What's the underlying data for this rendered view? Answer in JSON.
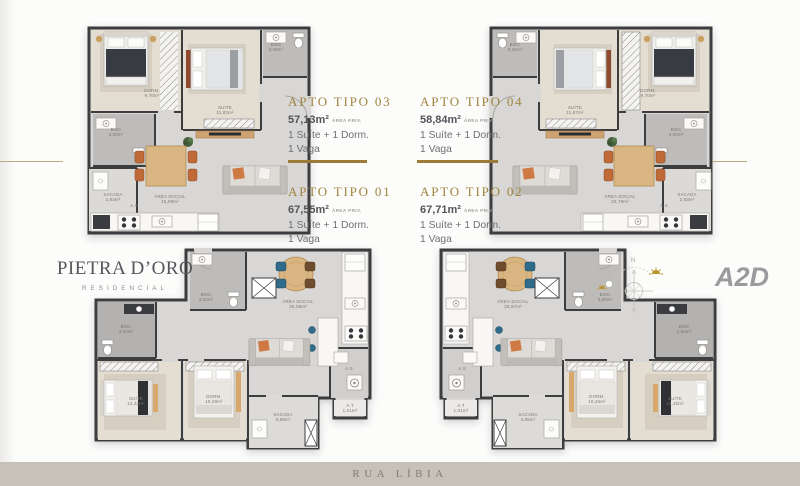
{
  "brand": {
    "name": "PIETRA D’ORO",
    "subtitle": "RESIDENCIAL"
  },
  "partner_logo": {
    "text": "A2D"
  },
  "compass": {
    "north_label": "N"
  },
  "footer": {
    "street_label": "RUA LÍBIA"
  },
  "colors": {
    "gold": "#a0843f",
    "rule_thin": "#bfa87e",
    "bar_gold": "#9c7b3a",
    "footer_bg": "#c6c2ba"
  },
  "units": {
    "items": [
      {
        "id": "tipo03",
        "title": "APTO TIPO 03",
        "area": "57,13m²",
        "area_note": "ÁREA PRIV.",
        "line1": "1 Suíte + 1 Dorm.",
        "line2": "1 Vaga"
      },
      {
        "id": "tipo04",
        "title": "APTO TIPO 04",
        "area": "58,84m²",
        "area_note": "ÁREA PRIV.",
        "line1": "1 Suíte + 1 Dorm.",
        "line2": "1 Vaga"
      },
      {
        "id": "tipo01",
        "title": "APTO TIPO 01",
        "area": "67,55m²",
        "area_note": "ÁREA PRIV.",
        "line1": "1 Suíte + 1 Dorm.",
        "line2": "1 Vaga"
      },
      {
        "id": "tipo02",
        "title": "APTO TIPO 02",
        "area": "67,71m²",
        "area_note": "ÁREA PRIV.",
        "line1": "1 Suíte + 1 Dorm.",
        "line2": "1 Vaga"
      }
    ]
  },
  "plans": {
    "tipo03": {
      "rooms": {
        "dorm": {
          "name": "DORM.",
          "area": "9,70m²"
        },
        "suite": {
          "name": "SUÍTE",
          "area": "11,82m²"
        },
        "bwc_top": {
          "name": "BWC",
          "area": "3,09m²"
        },
        "bwc_side": {
          "name": "BWC",
          "area": "3,00m²"
        },
        "sacada": {
          "name": "SACADA",
          "area": "2,83m²"
        },
        "social": {
          "name": "ÁREA SOCIAL",
          "area": "15,98m²"
        },
        "service": {
          "name": "A.S"
        }
      }
    },
    "tipo04": {
      "rooms": {
        "bwc_top": {
          "name": "BWC",
          "area": "3,25m²"
        },
        "suite": {
          "name": "SUÍTE",
          "area": "11,67m²"
        },
        "dorm": {
          "name": "DORM.",
          "area": "9,70m²"
        },
        "bwc_side": {
          "name": "BWC",
          "area": "3,00m²"
        },
        "sacada": {
          "name": "SACADA",
          "area": "2,83m²"
        },
        "social": {
          "name": "ÁREA SOCIAL",
          "area": "20,79m²"
        },
        "service": {
          "name": "A.S"
        }
      }
    },
    "tipo01": {
      "rooms": {
        "social": {
          "name": "ÁREA SOCIAL",
          "area": "26,08m²"
        },
        "bwc_entry": {
          "name": "BWC",
          "area": "3,00m²"
        },
        "bwc_suite": {
          "name": "BWC",
          "area": "3,60m²"
        },
        "suite": {
          "name": "SUÍTE",
          "area": "12,32m²"
        },
        "dorm": {
          "name": "DORM.",
          "area": "10,28m²"
        },
        "sacada": {
          "name": "SACADA",
          "area": "3,98m²"
        },
        "service": {
          "name": "A.S"
        },
        "tech": {
          "name": "A.T",
          "area": "1,01m²"
        }
      }
    },
    "tipo02": {
      "rooms": {
        "social": {
          "name": "ÁREA SOCIAL",
          "area": "25,97m²"
        },
        "bwc_entry": {
          "name": "BWC",
          "area": "3,00m²"
        },
        "bwc_suite": {
          "name": "BWC",
          "area": "3,60m²"
        },
        "dorm": {
          "name": "DORM.",
          "area": "10,26m²"
        },
        "suite": {
          "name": "SUÍTE",
          "area": "12,32m²"
        },
        "sacada": {
          "name": "SACADA",
          "area": "3,95m²"
        },
        "service": {
          "name": "A.S"
        },
        "tech": {
          "name": "A.T",
          "area": "1,01m²"
        }
      }
    }
  }
}
